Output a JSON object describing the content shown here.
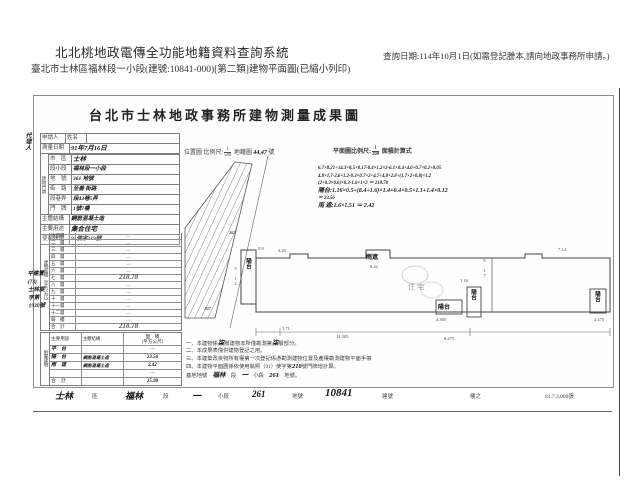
{
  "header": {
    "system_title": "北北桃地政電傳全功能地籍資料查詢系統",
    "query_info": "查詢日期:114年10月1日(如需登記謄本,請向地政事務所申請。)",
    "subtitle": "臺北市士林區福林段一小段(建號:10841-000)[第二類]建物平面圖(已縮小列印)"
  },
  "doc": {
    "title": "台北市士林地政事務所建物測量成果圖",
    "agent_label": "代理人",
    "form": {
      "applicant": "申請人",
      "name": "姓名",
      "survey_label": "測量日期",
      "survey_value": "91年7月16日",
      "addr_group": "建物門牌",
      "rows": [
        {
          "l": "市　區",
          "v": "士林"
        },
        {
          "l": "段小段",
          "v": "福林段一小段"
        },
        {
          "l": "地　號",
          "v": "361 地號"
        },
        {
          "l": "街　路",
          "v": "至善 街路"
        },
        {
          "l": "段巷弄",
          "v": "段43巷5弄"
        },
        {
          "l": "門　牌",
          "v": "1號7樓"
        },
        {
          "l": "主體結構",
          "v": "鋼筋混凝土造"
        },
        {
          "l": "主要用途",
          "v": "集合住宅"
        },
        {
          "l": "使用執照",
          "v": "91使字219號"
        }
      ]
    },
    "stamp": "平建置\n(73)\n士林度\n字第\n1930號",
    "area": {
      "side": "建物面積（平方公尺）",
      "rows": [
        {
          "f": "地面層",
          "v": "—"
        },
        {
          "f": "二　層",
          "v": "—"
        },
        {
          "f": "三　層",
          "v": "—"
        },
        {
          "f": "四　層",
          "v": "—"
        },
        {
          "f": "五　層",
          "v": "—"
        },
        {
          "f": "六　層",
          "v": "—"
        },
        {
          "f": "七　層",
          "v": "218.78"
        },
        {
          "f": "八　層",
          "v": "—"
        },
        {
          "f": "九　層",
          "v": "—"
        },
        {
          "f": "十　層",
          "v": "—"
        },
        {
          "f": "十一層",
          "v": "—"
        },
        {
          "f": "十二層",
          "v": "—"
        },
        {
          "f": "騎　樓",
          "v": "—"
        },
        {
          "f": "合　計",
          "v": "218.78"
        }
      ]
    },
    "annex": {
      "side": "附屬建物",
      "h_use": "主要用途",
      "h_struct": "主體結構",
      "h_area": "面　積",
      "h_area2": "（平方公尺）",
      "rows": [
        {
          "u": "平　台",
          "s": "",
          "a": "—"
        },
        {
          "u": "陽　台",
          "s": "鋼筋混凝土造",
          "a": "23.56"
        },
        {
          "u": "雨　遮",
          "s": "鋼筋混凝土造",
          "a": "2.42"
        },
        {
          "u": "",
          "s": "",
          "a": "—"
        },
        {
          "u": "合　計",
          "s": "",
          "a": "25.98"
        }
      ]
    },
    "scales": {
      "loc_label": "位置圖 比例尺:",
      "loc_num": "1",
      "loc_den": "500",
      "loc_map": "地籍圖",
      "loc_sheet": "44,47",
      "loc_no": "號",
      "plan_label": "平面圖比例尺:",
      "plan_num": "1",
      "plan_den": "200",
      "plan_calc": "面積計算式"
    },
    "calc": {
      "l1": "6.7×8.21+14.3×8.5×8.17-8.4×1.2×2-6.1×0.4+4.6+0.7×0.2+8.05",
      "l2": "4.8×1.7-2.6×1.2-0.3×0.7×2+4.7+4.8×2.8+(1.7×2+0.8)×1.2",
      "l3": "(2+0.3×0.6)×0.3-1.6×1×2 ＝ 218.78",
      "l4": "陽台:1.16×0.5+(8.4+1.6)×1.4+0.4×0.5×1.1+1.4×0.12",
      "l5": "＝ 23.56",
      "l6": "雨 遮:1.6×1.51 ＝ 2.42"
    },
    "plan": {
      "balcony": "陽台",
      "eave": "雨遮",
      "dwelling": "住宅",
      "dims": {
        "left_h": "5.12",
        "bot1": "1.71",
        "bot2": "14.305",
        "bot3": "8.475",
        "right_h": "8.17",
        "eave_w": "8.42",
        "bal_w": "4.305",
        "right_w": "2.475",
        "top1": "0.9",
        "top2": "4.26",
        "top3": "7.14",
        "mid": "1.16"
      },
      "map": {
        "n1": "263",
        "n2": "107"
      }
    },
    "notes": {
      "n1a": "一、本建物係",
      "n1b": "柒",
      "n1c": "層建物本所僅勘測第",
      "n1d": "柒",
      "n1e": "層部分。",
      "n2": "二、本成果表僅供建物登記之用。",
      "n3": "三、本建築改良物所有權第一次登記係憑勘測建物位置及產權勘測建物平面手冊",
      "n4a": "四、本建物平面圖係依使用執照（91）使字第",
      "n4b": "218",
      "n4c": "號門牌增計算。",
      "b1": "基地地號",
      "b2": "福林",
      "b3": "段",
      "b4": "一",
      "b5": "小段",
      "b6": "261",
      "b7": "地號。"
    },
    "strip": {
      "s1": "士林",
      "s2": "區",
      "s3": "福林",
      "s4": "段",
      "s5": "一",
      "s6": "小段",
      "s7": "261",
      "s8": "地號",
      "s9": "10841",
      "s10": "建號",
      "s11": "樓之",
      "print_info": "81.7.3,000張"
    }
  }
}
